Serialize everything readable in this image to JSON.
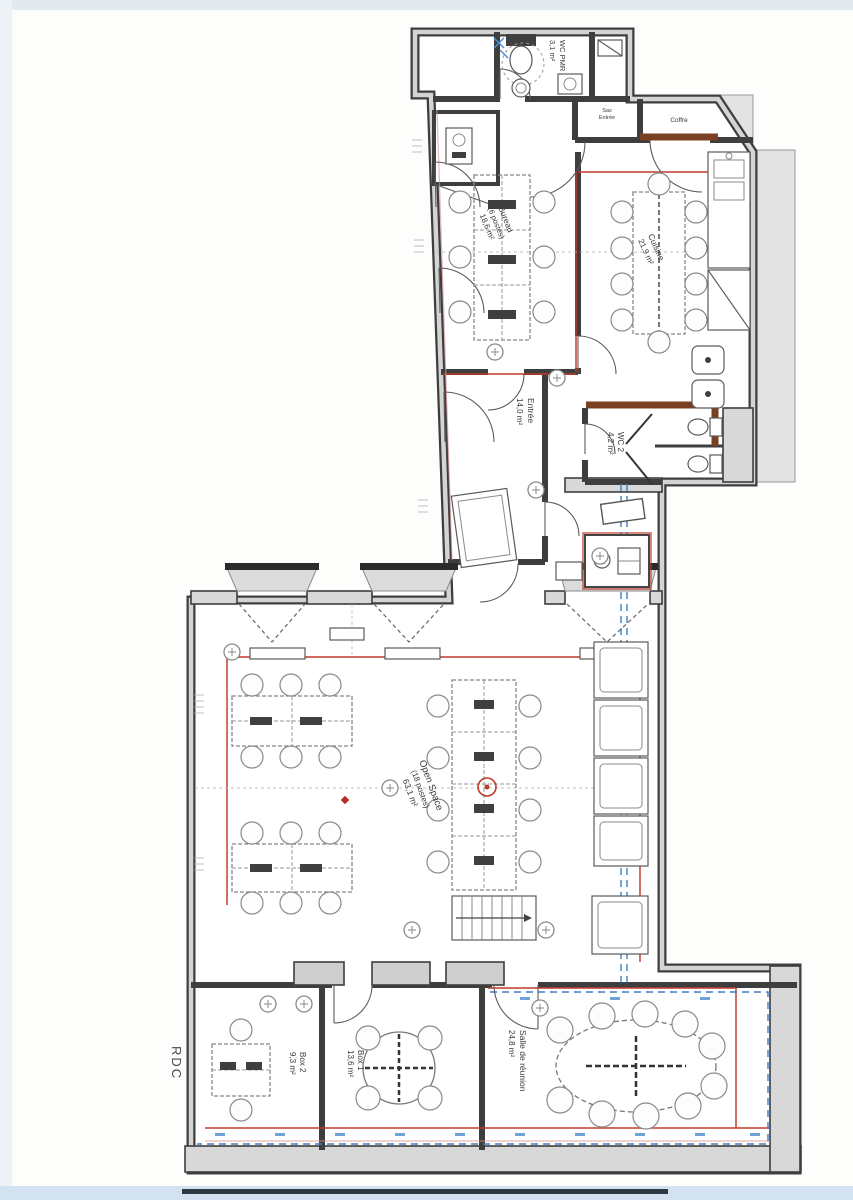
{
  "page": {
    "title": "Plan d'aménagement",
    "floor_label": "RDC"
  },
  "colors": {
    "wall": "#3e3e3e",
    "wall_core": "#d6d6d6",
    "new_partition_red": "#c0392b",
    "partition_brown": "#7a4022",
    "utility_blue": "#3d7dc2",
    "paper": "#fdfdfc"
  },
  "rooms": {
    "wc_pmr": {
      "name": "WC PMR",
      "area": "3,1 m²"
    },
    "bureau": {
      "name": "Bureau",
      "capacity": "(6 postes)",
      "area": "18,6 m²"
    },
    "cuisine": {
      "name": "Cuisine",
      "area": "21,9 m²"
    },
    "entree": {
      "name": "Entrée",
      "area": "14,0 m²"
    },
    "wc2": {
      "name": "WC 2",
      "area": "4,2 m²"
    },
    "open_space": {
      "name": "Open Space",
      "capacity": "(18 postes)",
      "area": "63,1 m²"
    },
    "box2": {
      "name": "Box 2",
      "area": "9,3 m²"
    },
    "box1": {
      "name": "Box 1",
      "area": "13,6 m²"
    },
    "salle_reunion": {
      "name": "Salle de réunion",
      "area": "24,8 m²"
    },
    "sas_entree": {
      "line1": "Sas",
      "line2": "Entrée"
    },
    "coffre": {
      "name": "Coffre"
    }
  }
}
